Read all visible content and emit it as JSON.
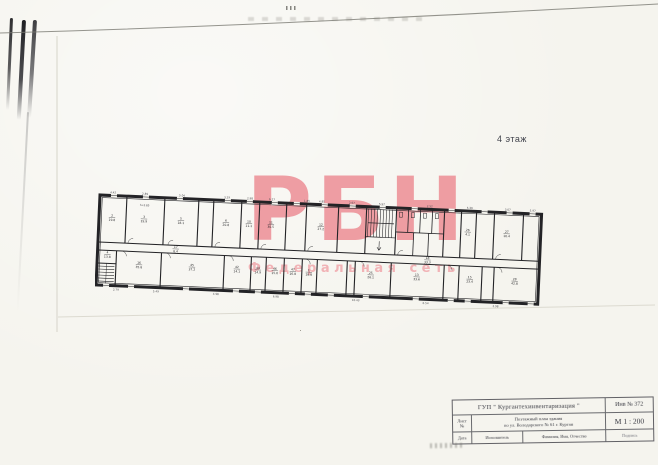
{
  "floor_label": "4 этаж",
  "watermark": {
    "letters": "РБН",
    "subtitle": "Федеральная сеть",
    "color": "#ec858d",
    "subtitle_color": "#f09da3"
  },
  "title_block": {
    "org": "ГУП \" Кургантехинвентаризация \"",
    "inventory_no": "Инв № 372",
    "sheet_label": "Лист",
    "sheet_no_label": "№",
    "doc_title_line1": "Поэтажный план здания",
    "doc_title_line2": "по ул. Володарского № 61  г. Курган",
    "scale": "М 1 : 200",
    "date_label": "Дата",
    "executor_label": "Исполнитель",
    "name_label": "Фамилия, Имя, Отчество",
    "signature_label": "Подпись"
  },
  "plan": {
    "height_note": {
      "t": "h=2.85",
      "x": 45,
      "y": 9.2
    },
    "rooms_top": [
      {
        "num": "2",
        "area": "19.8",
        "x": 13,
        "y": 21
      },
      {
        "num": "3",
        "area": "19.9",
        "x": 45,
        "y": 21
      },
      {
        "num": "5",
        "area": "18.1",
        "x": 82,
        "y": 21
      },
      {
        "num": "6",
        "area": "20.8",
        "x": 127,
        "y": 21
      },
      {
        "num": "10",
        "area": "11.1",
        "x": 150,
        "y": 21
      },
      {
        "num": "11",
        "area": "30.5",
        "x": 172,
        "y": 21
      },
      {
        "num": "12",
        "area": "27.2",
        "x": 222,
        "y": 21
      },
      {
        "num": "26",
        "area": "4.1",
        "x": 369,
        "y": 20
      },
      {
        "num": "27",
        "area": "16.4",
        "x": 408,
        "y": 20
      }
    ],
    "corridor_labels": [
      {
        "num": "17",
        "area": "8.4",
        "x": 78,
        "y": 49.6
      },
      {
        "num": "18",
        "area": "33.3",
        "x": 330,
        "y": 49.6
      }
    ],
    "rooms_bottom": [
      {
        "num": "4",
        "area": "13.8",
        "x": 10,
        "y": 58
      },
      {
        "num": "16",
        "area": "35.8",
        "x": 42,
        "y": 67
      },
      {
        "num": "45",
        "area": "37.2",
        "x": 95,
        "y": 67
      },
      {
        "num": "42",
        "area": "14.1",
        "x": 140,
        "y": 67
      },
      {
        "num": "44",
        "area": "14.9",
        "x": 161,
        "y": 67
      },
      {
        "num": "46",
        "area": "15.6",
        "x": 178,
        "y": 67
      },
      {
        "num": "47",
        "area": "16.8",
        "x": 196,
        "y": 67
      },
      {
        "num": "1",
        "area": "18.8",
        "x": 212,
        "y": 67
      },
      {
        "num": "25",
        "area": "26.1",
        "x": 274,
        "y": 67
      },
      {
        "num": "13",
        "area": "33.6",
        "x": 320,
        "y": 67
      },
      {
        "num": "15",
        "area": "23.4",
        "x": 373,
        "y": 67
      },
      {
        "num": "28",
        "area": "42.8",
        "x": 418,
        "y": 67
      }
    ],
    "dims_top": [
      {
        "t": "4.42",
        "x": 13
      },
      {
        "t": "2.89",
        "x": 45
      },
      {
        "t": "5.04",
        "x": 82
      },
      {
        "t": "3.29",
        "x": 127
      },
      {
        "t": "2.98",
        "x": 150
      },
      {
        "t": "6.27",
        "x": 172
      },
      {
        "t": "1.85",
        "x": 207
      },
      {
        "t": "4.85",
        "x": 222
      },
      {
        "t": "2.97",
        "x": 252
      },
      {
        "t": "5.97",
        "x": 282
      },
      {
        "t": "2.52",
        "x": 330
      },
      {
        "t": "5.30",
        "x": 370
      },
      {
        "t": "3.07",
        "x": 408
      },
      {
        "t": "5.97",
        "x": 433
      }
    ],
    "dims_bottom": [
      {
        "t": "2.79",
        "x": 20
      },
      {
        "t": "5.49",
        "x": 60
      },
      {
        "t": "4.98",
        "x": 120
      },
      {
        "t": "6.98",
        "x": 180
      },
      {
        "t": "10.43",
        "x": 260
      },
      {
        "t": "6.54",
        "x": 330
      },
      {
        "t": "2.98",
        "x": 400
      }
    ],
    "windows_top": [
      14,
      46,
      80,
      128,
      150,
      175,
      197,
      225,
      253,
      283,
      315,
      352,
      385,
      410,
      433
    ],
    "windows_bottom": [
      10,
      35,
      90,
      140,
      162,
      196,
      212,
      235,
      270,
      320,
      355,
      372,
      410,
      435
    ]
  }
}
